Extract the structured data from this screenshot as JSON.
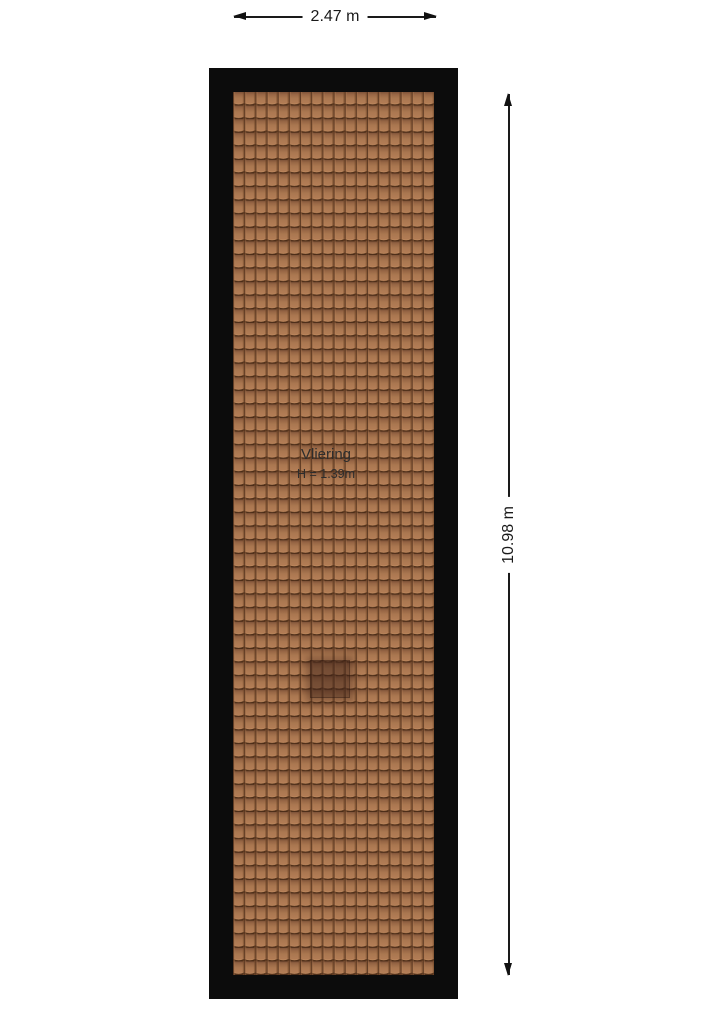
{
  "dimensions": {
    "width": {
      "label": "2.47 m"
    },
    "height": {
      "label": "10.98 m"
    }
  },
  "room": {
    "name": "Vliering",
    "height_label": "H = 1.39m"
  },
  "colors": {
    "background": "#ffffff",
    "wall": "#0c0c0c",
    "tile_base": "#aa7750",
    "tile_shadow": "#4c2d18",
    "tile_highlight": "#c58f63",
    "roof_window_overlay": "rgba(61,34,23,0.5)",
    "dimension_line": "#1a1a1a",
    "label_text": "#2d2d2d"
  }
}
